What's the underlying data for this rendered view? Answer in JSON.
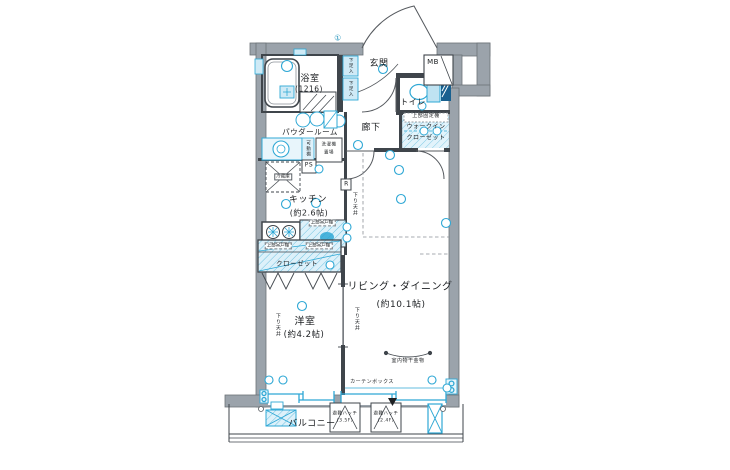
{
  "plan": {
    "rooms": {
      "bathroom": {
        "name": "浴室",
        "size": "(1216)"
      },
      "powder_room": {
        "name": "パウダールーム"
      },
      "entrance": {
        "name": "玄関"
      },
      "meter_box": {
        "name": "MB"
      },
      "toilet": {
        "name": "トイレ"
      },
      "hallway": {
        "name": "廊下"
      },
      "walk_in_closet": {
        "name_line1": "ウォークイン",
        "name_line2": "クローゼット",
        "upper_shelf": "上部固定棚"
      },
      "kitchen": {
        "name": "キッチン",
        "size": "(約2.6帖)"
      },
      "western_room": {
        "name": "洋室",
        "size": "(約4.2帖)"
      },
      "living_dining": {
        "name": "リビング・ダイニング",
        "size": "(約10.1帖)"
      },
      "closet": {
        "name": "クローゼット"
      },
      "balcony": {
        "name": "バルコニー"
      }
    },
    "labels": {
      "shoe_cabinet": "下足入",
      "movable_shelf": "可動棚",
      "washer_line1": "洗濯機",
      "washer_line2": "置場",
      "pipe_space": "PS",
      "refrigerator": "冷蔵庫",
      "upper_cabinet": "上部吊戸棚",
      "lowered_ceiling": "下り天井",
      "indoor_drying": "室内物干金物",
      "curtain_box": "カーテンボックス",
      "refrigerator_mark": "R",
      "circled_number": "①",
      "escape_hatch": "避難ハッチ",
      "hatch1_floor": "(3.5F)",
      "hatch2_floor": "(2.4F)"
    },
    "colors": {
      "wall": "#9ba3ab",
      "line": "#3f454b",
      "accent": "#2fa8d5",
      "accent_fill": "#d8eff9"
    }
  }
}
